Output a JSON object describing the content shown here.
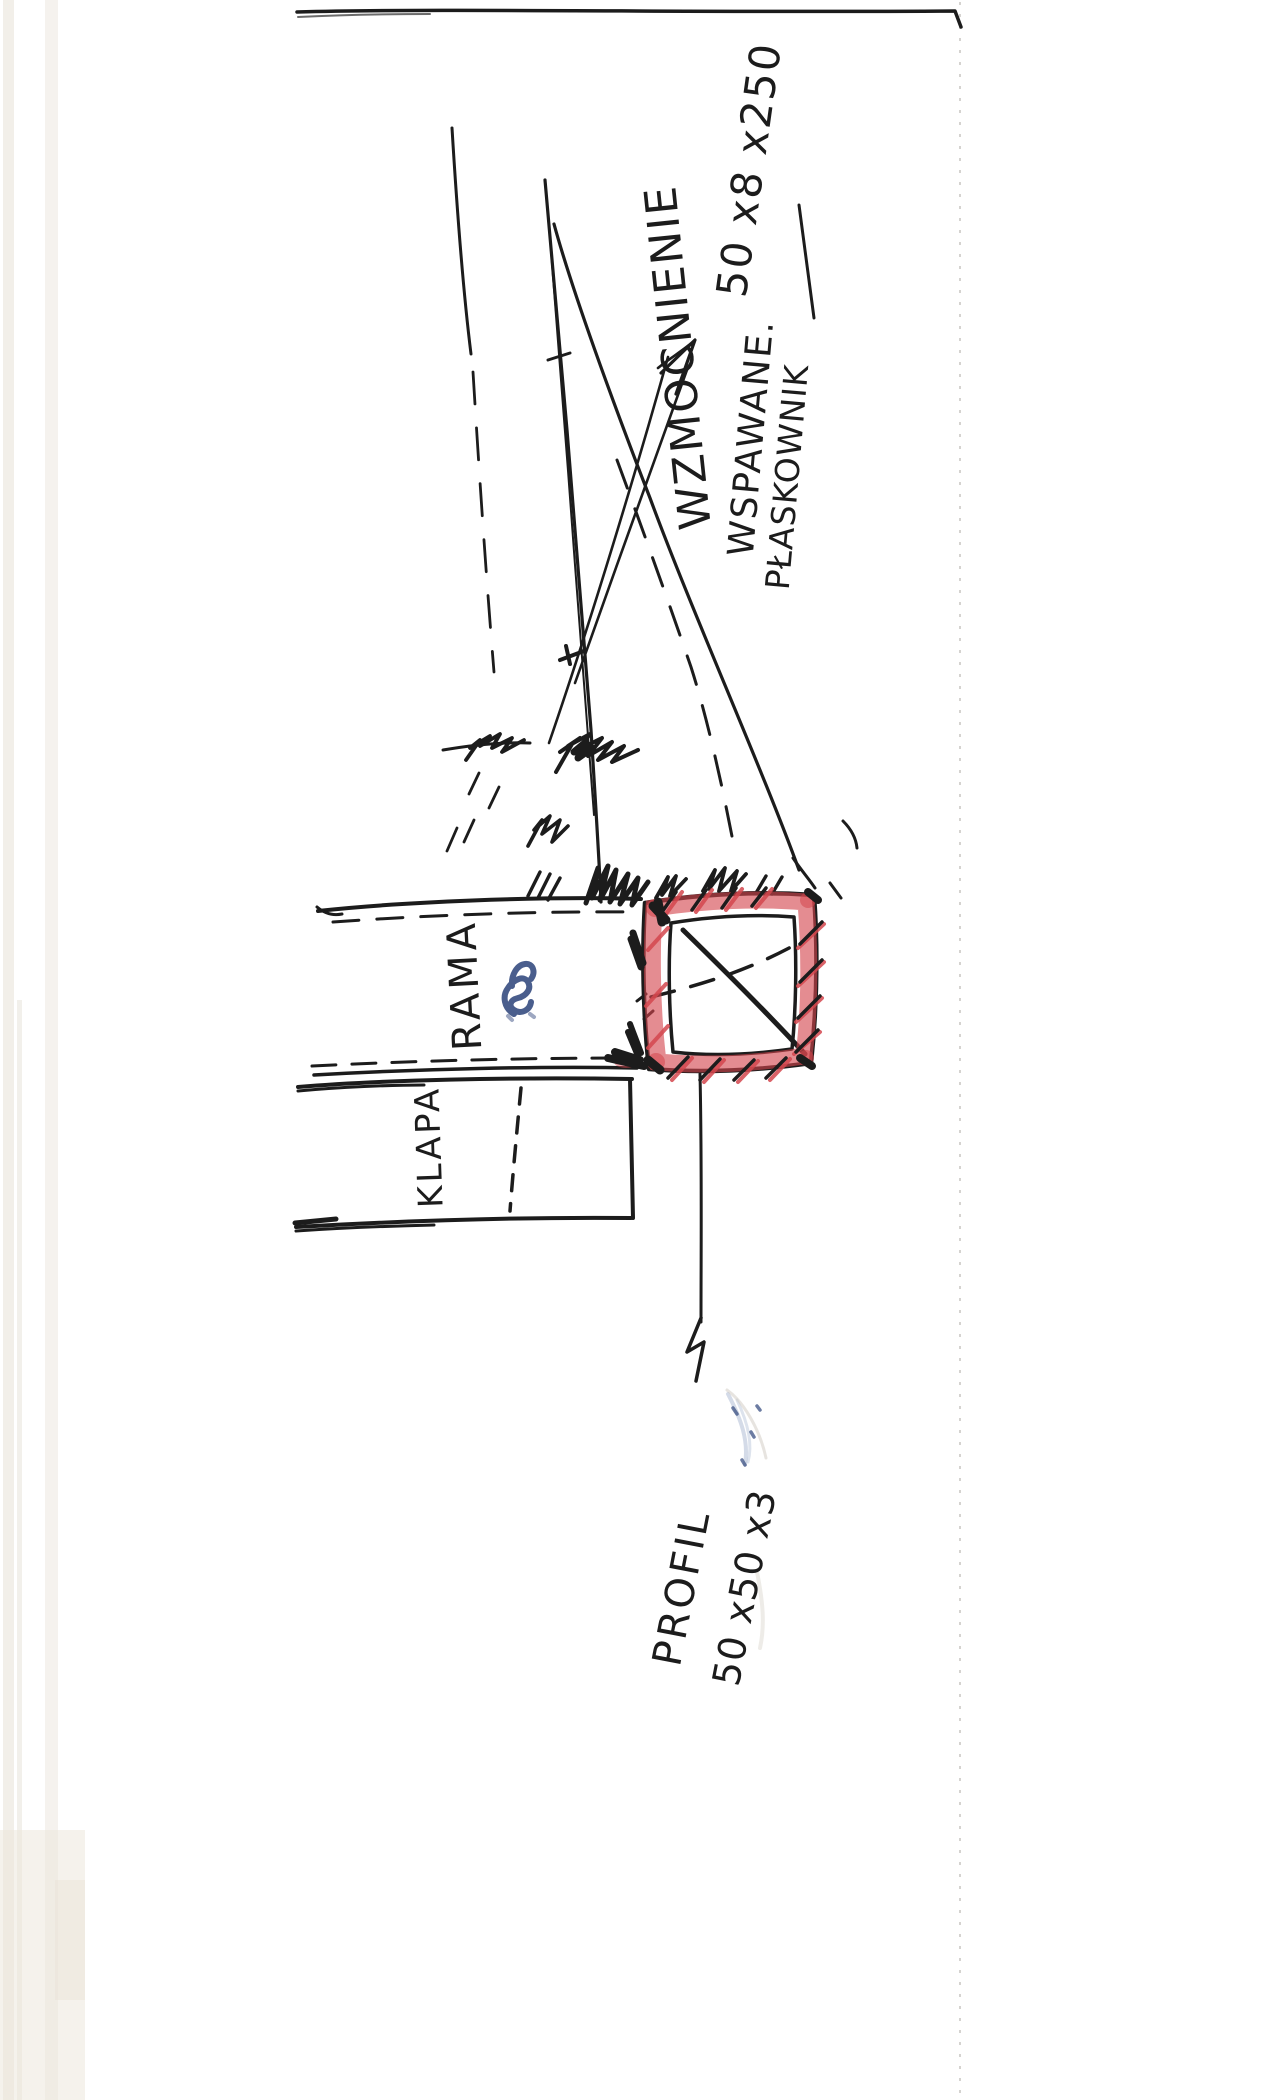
{
  "document": {
    "kind_label": "hand-drawn welding sketch"
  },
  "labels": {
    "wzmocnienie": "WZMOCNIENIE",
    "wspawane": "WSPAWANE.",
    "plaskownik": "PŁASKOWNIK",
    "flat_bar_dims": "50 x8 x250",
    "rama": "RAMA",
    "klapa": "KLAPA",
    "profil": "PROFIL",
    "profil_dims": "50 x50 x3"
  },
  "colors": {
    "ink": "#1c1c1c",
    "red_marker": "#d4464d",
    "blue_ink": "#3b5083",
    "smudge_blue": "#9fb0cc",
    "paper": "#ffffff"
  }
}
